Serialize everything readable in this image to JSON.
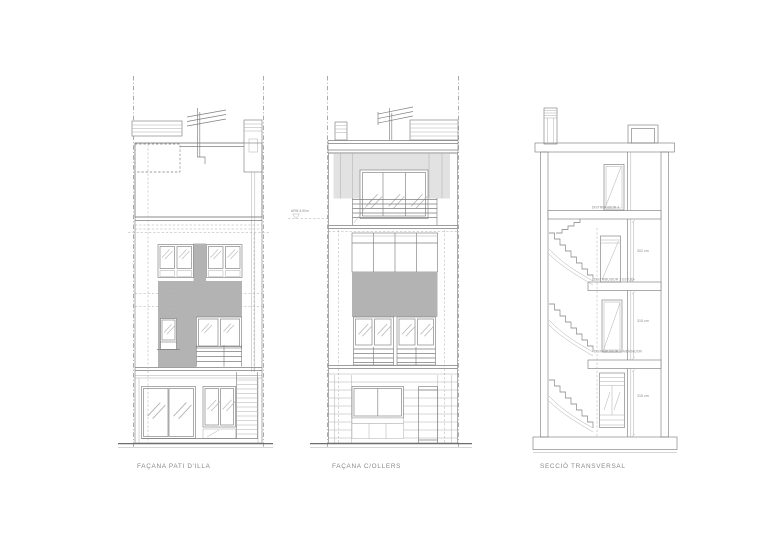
{
  "sheet": {
    "background": "#ffffff"
  },
  "colors": {
    "line": "#7f7f7f",
    "line_light": "#aeaeae",
    "panel_gray": "#b3b3b3",
    "light_gray": "#e2e2e2",
    "label_text": "#8a8a8a"
  },
  "facade_pati": {
    "title": "FAÇANA PATI D'ILLA"
  },
  "facade_ollers": {
    "title": "FAÇANA C/OLLERS",
    "height_note": "ARM 8,50m"
  },
  "section": {
    "title": "SECCIÓ TRANSVERSAL",
    "room_top": "DISTRIBUIDOR 4",
    "room_3": "DISTRIBUIDOR 3",
    "room_3b": "ESTUDI",
    "room_2": "DISTRIBUIDOR 2",
    "room_2b": "MENJADOR",
    "dim_3": "302 cm",
    "dim_2": "315 cm",
    "dim_1": "315 cm"
  }
}
